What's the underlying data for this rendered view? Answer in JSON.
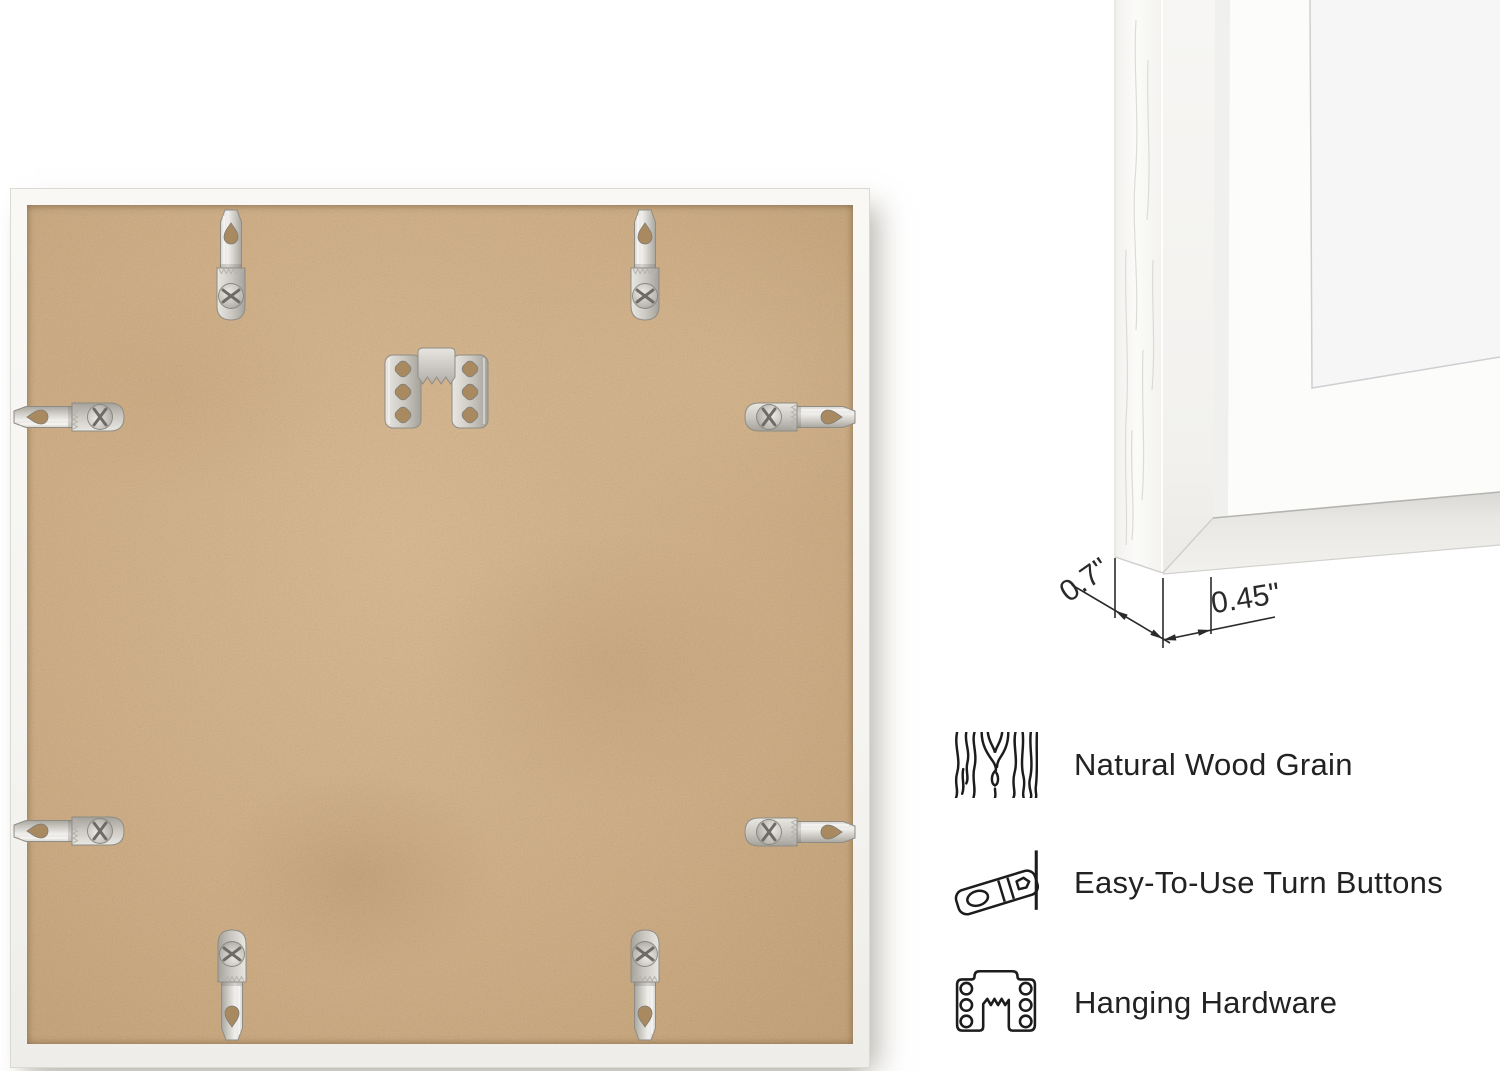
{
  "measurements": {
    "frame_depth": "0.7\"",
    "frame_face_width": "0.45\""
  },
  "features": [
    {
      "icon": "wood-grain-icon",
      "label": "Natural Wood Grain"
    },
    {
      "icon": "turn-button-icon",
      "label": "Easy-To-Use Turn Buttons"
    },
    {
      "icon": "hanging-hardware-icon",
      "label": "Hanging Hardware"
    }
  ],
  "colors": {
    "background": "#ffffff",
    "mdf_board": "#cdab81",
    "frame_white": "#f7f6f3",
    "metal": "#c9c6c0",
    "ink": "#1d1d1d"
  }
}
